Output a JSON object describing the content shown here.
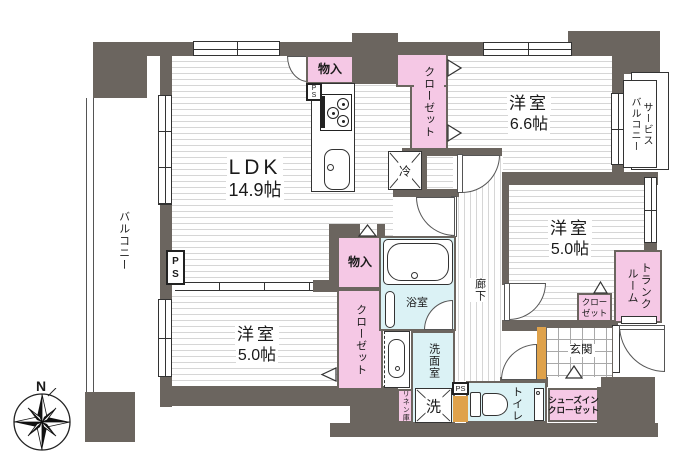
{
  "compass": {
    "north_label": "N"
  },
  "rooms": {
    "ldk": {
      "label": "LDK",
      "area": "14.9帖"
    },
    "bedroom_north": {
      "label": "洋室",
      "area": "6.6帖"
    },
    "bedroom_east": {
      "label": "洋室",
      "area": "5.0帖"
    },
    "bedroom_southwest": {
      "label": "洋室",
      "area": "5.0帖"
    },
    "balcony": {
      "label": "バルコニー"
    },
    "service_balcony": {
      "lines": [
        "サービス",
        "バルコニー"
      ]
    },
    "corridor": {
      "label": "廊下"
    },
    "entrance": {
      "label": "玄関"
    },
    "bathroom": {
      "label": "浴室"
    },
    "washroom": {
      "label": "洗面室"
    },
    "toilet": {
      "label": "トイレ"
    },
    "trunk_room": {
      "lines": [
        "トランク",
        "ルーム"
      ]
    }
  },
  "storage": {
    "storage_north": {
      "label": "物入"
    },
    "closet_north": {
      "label": "クローゼット"
    },
    "storage_center": {
      "label": "物入"
    },
    "closet_west": {
      "label": "クローゼット"
    },
    "closet_east": {
      "lines": [
        "クロー",
        "ゼット"
      ]
    },
    "shoes_in_closet": {
      "lines": [
        "シューズイン",
        "クローゼット"
      ]
    },
    "linen": {
      "label": "リネン庫"
    }
  },
  "fixtures": {
    "refrigerator": {
      "label": "冷"
    },
    "washing_machine": {
      "label": "洗"
    },
    "ps_kitchen": {
      "label": "PS"
    },
    "ps_wall": {
      "label": "PS"
    },
    "ps_south": {
      "label": "PS"
    }
  },
  "colors": {
    "wall": "#6b655f",
    "closet_pink": "#f5c8e5",
    "wet_area_blue": "#dbf2f5",
    "accent_orange": "#dfa24b"
  }
}
